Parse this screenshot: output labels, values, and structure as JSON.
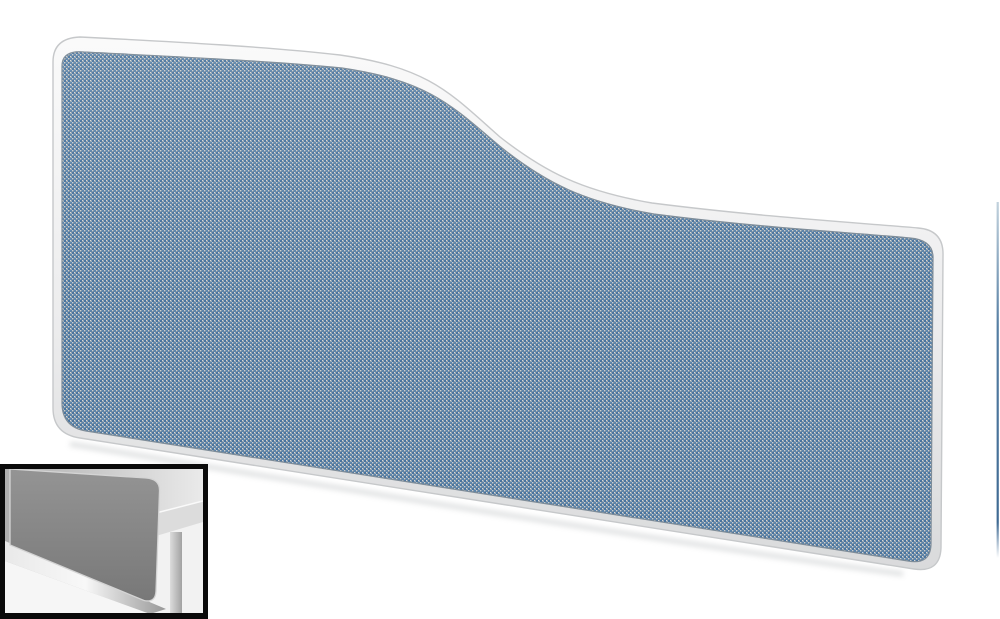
{
  "scene": {
    "description": "Product photo: wave-top desktop privacy screen in blue woven fabric with a white rounded frame, photographed on a plain white background",
    "background": "#ffffff"
  },
  "main_image": {
    "label": "blue fabric wave-top desk screen with white trim",
    "colors": {
      "frame_top": "#fafafa",
      "frame_bottom": "#d9dadb",
      "frame_outline": "#c6c8ca",
      "fabric_base": "#919da7",
      "fabric_blue_dark": "#4874a0",
      "fabric_blue_light": "#5b84ab",
      "fabric_speck_light": "#d2d9de",
      "fabric_speck_mid": "#c6cfd6",
      "fabric_outline": "#7e8c98",
      "drop_shadow": "#b9bdbf"
    }
  },
  "thumbnail": {
    "label": "inset gallery thumbnail: grey desk screen mounted on a desk, monochrome photo",
    "border_color": "#0a0a0a",
    "colors": {
      "wall_left": "#aeaeae",
      "wall_right": "#eaeaea",
      "panel_top": "#949494",
      "panel_bottom": "#787878",
      "panel_edge": "#d4d4d4",
      "desk_band": "#dcdcdc",
      "desk_band_highlight": "#fafafa",
      "lower_area": "#f2f2f2",
      "leg_light": "#dcdcdc",
      "leg_dark": "#a2a2a2",
      "rail_light": "#f8f8f8",
      "rail_dark": "#989898",
      "under_rail": "#f6f6f6"
    }
  },
  "adjacent_sliver": {
    "label": "thin edge of adjacent product image cropped at the right border",
    "color_top": "#c2d2dd",
    "color_mid": "#557ea3",
    "color_bottom": "#3f6a93"
  }
}
